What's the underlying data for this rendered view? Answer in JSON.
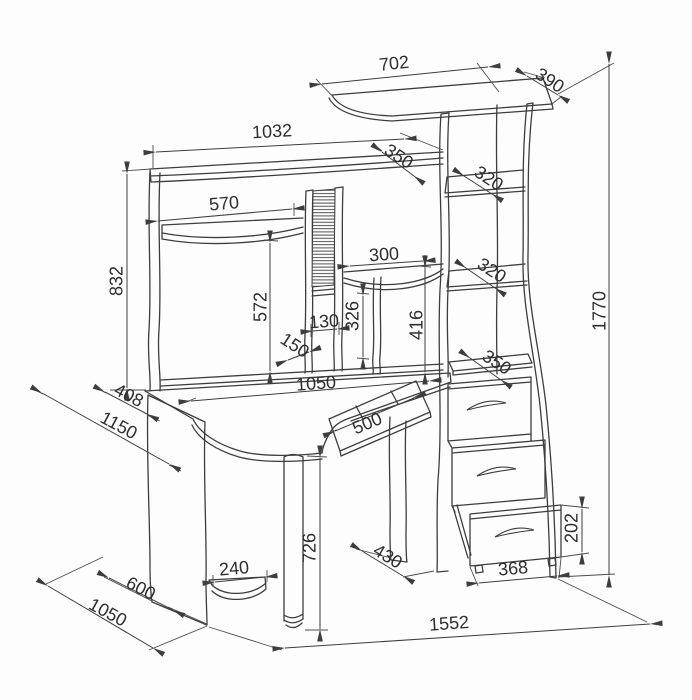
{
  "drawing": {
    "kind": "dimensioned furniture drawing — corner computer desk with hutch, shelf tower and three drawers",
    "style": {
      "line_color": "#3d3d3d",
      "text_color": "#2e2e2e",
      "background": "#fdfdfd"
    },
    "labels": {
      "d702": "702",
      "d390": "390",
      "d1032": "1032",
      "d350_hutch": "350",
      "d570": "570",
      "d832": "832",
      "d300": "300",
      "d320_upper": "320",
      "d320_lower": "320",
      "d350_tower": "350",
      "d572": "572",
      "d130": "130",
      "d150": "150",
      "d326": "326",
      "d416": "416",
      "d1050_desk": "1050",
      "d408": "408",
      "d1150": "1150",
      "d500": "500",
      "d726": "726",
      "d240": "240",
      "d600": "600",
      "d1050_floor": "1050",
      "d430": "430",
      "d368": "368",
      "d202": "202",
      "d1552": "1552",
      "d1770": "1770"
    }
  }
}
